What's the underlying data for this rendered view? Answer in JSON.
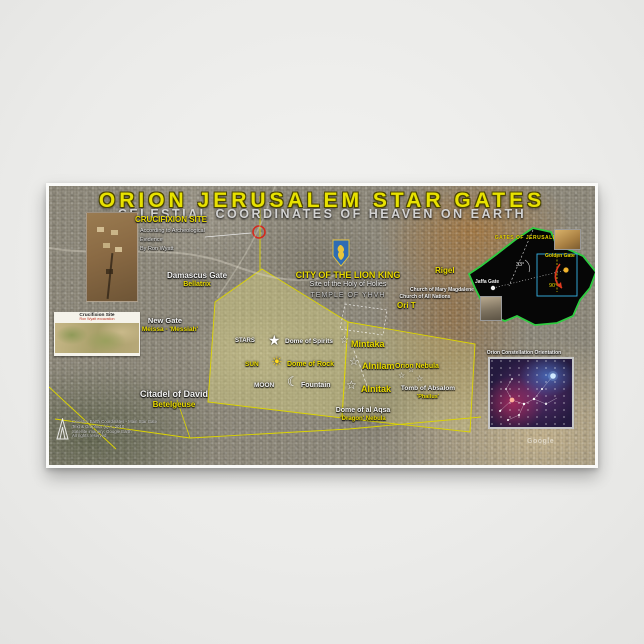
{
  "poster": {
    "title": "ORION JERUSALEM STAR GATES",
    "subtitle": "CELESTIAL COORDINATES OF HEAVEN ON EARTH",
    "accent_color": "#e8e200",
    "wall_overlay_color": "#dcd400",
    "inset_outline_color": "#2ecc40"
  },
  "crucifixion_site": {
    "title": "CRUCIFIXION SITE",
    "line1": "According to Archeological",
    "line2": "Evidence",
    "line3": "By Ron Wyatt"
  },
  "gates": {
    "damascus": {
      "name": "Damascus Gate",
      "star": "Bellatrix"
    },
    "new_gate": {
      "name": "New Gate",
      "star": "Meissa - 'Messiah'"
    },
    "citadel": {
      "name": "Citadel of David",
      "star": "Betelgeuse"
    }
  },
  "temple": {
    "title": "CITY OF THE LION KING",
    "line1": "Site of the Holy of Holies",
    "line2": "TEMPLE OF YHVH"
  },
  "churches": {
    "mary_magdalene": "Church of Mary Magdalene",
    "all_nations": "Church of All Nations",
    "ori_t": "Ori T"
  },
  "belt": {
    "stars_label": "STARS",
    "dome_of_spirits": "Dome of Spirits",
    "mintaka": "Mintaka",
    "sun_label": "SUN",
    "dome_of_rock": "Dome of Rock",
    "alnilam": "Alnilam",
    "moon_label": "MOON",
    "fountain": "Fountain",
    "alnitak": "Alnitak"
  },
  "nebulae": {
    "orion_nebula": "Orion Nebula",
    "tomb_of_absalom": "Tomb of Absalom",
    "tomb_note": "'Phallus'",
    "al_aqsa": "Dome of al Aqsa",
    "dragon_nebula": "'Dragon' Nebula"
  },
  "stars": {
    "rigel": "Rigel"
  },
  "inset_gates": {
    "title": "GATES OF JERUSALEM",
    "golden_gate": "Golden Gate",
    "jaffa_gate": "Jaffa Gate",
    "angle_33": "33°",
    "angle_90": "90°"
  },
  "inset_orion": {
    "title": "Orion Constellation Orientation"
  },
  "inset_crucifixion_card": {
    "title": "Crucifixion Site",
    "subtitle": "Ron Wyatt excavation"
  },
  "credits": {
    "line1": "Celestial Earth Coordinates - Main Star Gate",
    "line2": "Text & Graphics (c) A. 2010",
    "line3": "Satellite imagery: Google Earth",
    "line4": "All rights reserved"
  },
  "watermark": "Google",
  "icons": {
    "star_solid": "★",
    "star_open": "☆",
    "sun": "☀",
    "moon": "☾"
  }
}
